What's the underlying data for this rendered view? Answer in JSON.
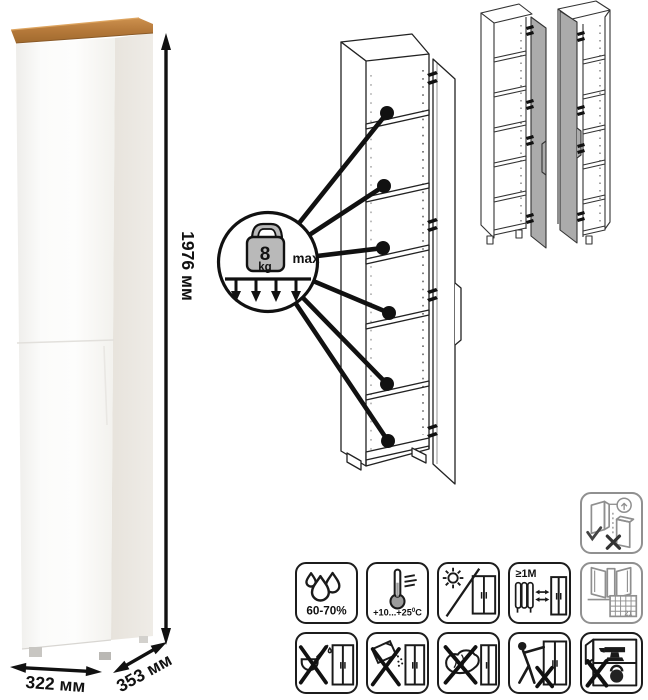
{
  "title": "Tall one-door cabinet infographic",
  "dimensions": {
    "height": "1976 мм",
    "width": "322 мм",
    "depth": "353 мм"
  },
  "load_callout": {
    "value": "8",
    "unit": "kg",
    "qualifier": "max"
  },
  "icons": {
    "wall_anchor": {
      "name": "anchor-to-wall-icon"
    },
    "humidity": {
      "name": "humidity-icon",
      "label": "60-70%"
    },
    "temperature": {
      "name": "temperature-icon",
      "range": "+10...+25",
      "degree": "0",
      "unit": "C"
    },
    "sunlight": {
      "name": "no-direct-sunlight-icon"
    },
    "heat_distance": {
      "name": "heat-distance-icon",
      "label": "≥1M"
    },
    "ventilation": {
      "name": "ventilation-calendar-icon",
      "calendar_day": "21"
    },
    "no_liquids": {
      "name": "no-wet-cleaning-icon"
    },
    "no_abrasives": {
      "name": "no-abrasive-powder-icon"
    },
    "no_scrubbing": {
      "name": "no-harsh-sponge-icon"
    },
    "no_dragging": {
      "name": "no-dragging-icon"
    },
    "no_overload": {
      "name": "no-overload-icon"
    }
  },
  "colors": {
    "wood_top": "#b5793a",
    "door_gray": "#ababab",
    "outline": "#1a1a1a",
    "muted_outline": "#8f8f8f"
  }
}
